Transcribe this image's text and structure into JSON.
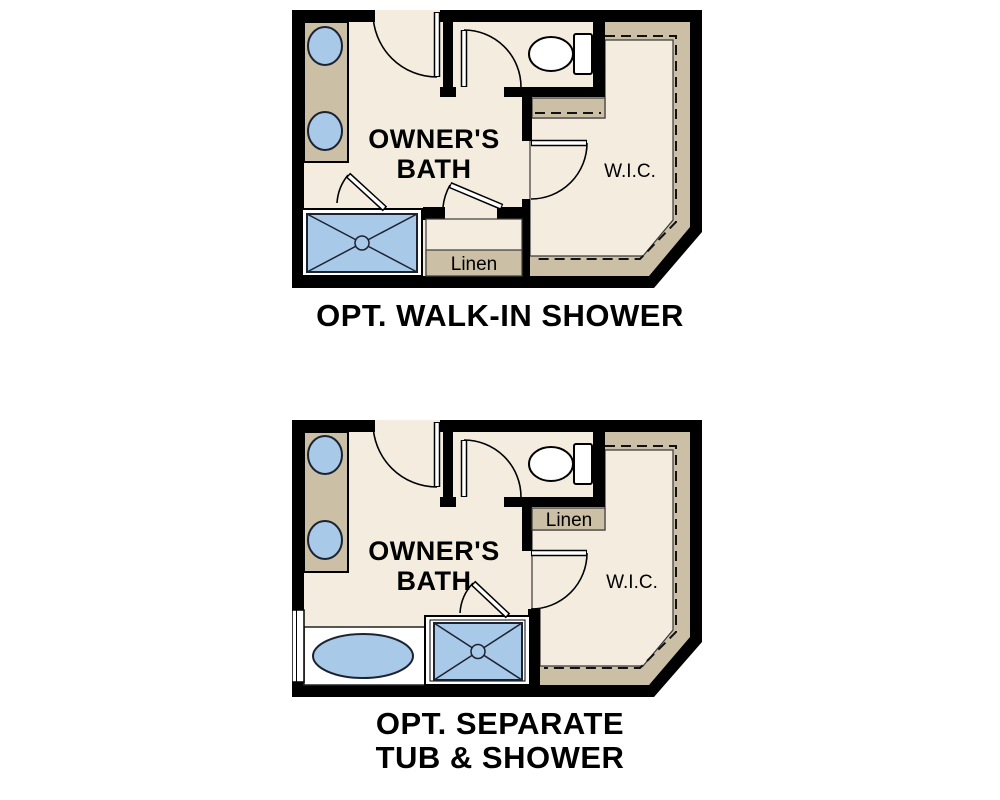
{
  "colors": {
    "wall": "#000000",
    "floor": "#f4eddf",
    "shelving": "#cbc0a6",
    "fixture_blue": "#a9c9e8",
    "background": "#ffffff"
  },
  "plans": [
    {
      "title": "OPT. WALK-IN SHOWER",
      "room_label_line1": "OWNER'S",
      "room_label_line2": "BATH",
      "closet_label": "W.I.C.",
      "linen_label": "Linen",
      "fixtures": [
        "double-sink-vanity",
        "toilet",
        "walk-in-shower",
        "linen-closet",
        "wic-shelving",
        "swing-doors"
      ]
    },
    {
      "title_line1": "OPT. SEPARATE",
      "title_line2": "TUB & SHOWER",
      "room_label_line1": "OWNER'S",
      "room_label_line2": "BATH",
      "closet_label": "W.I.C.",
      "linen_label": "Linen",
      "fixtures": [
        "double-sink-vanity",
        "toilet",
        "soaking-tub",
        "shower",
        "linen-closet",
        "wic-shelving",
        "window",
        "swing-doors"
      ]
    }
  ]
}
